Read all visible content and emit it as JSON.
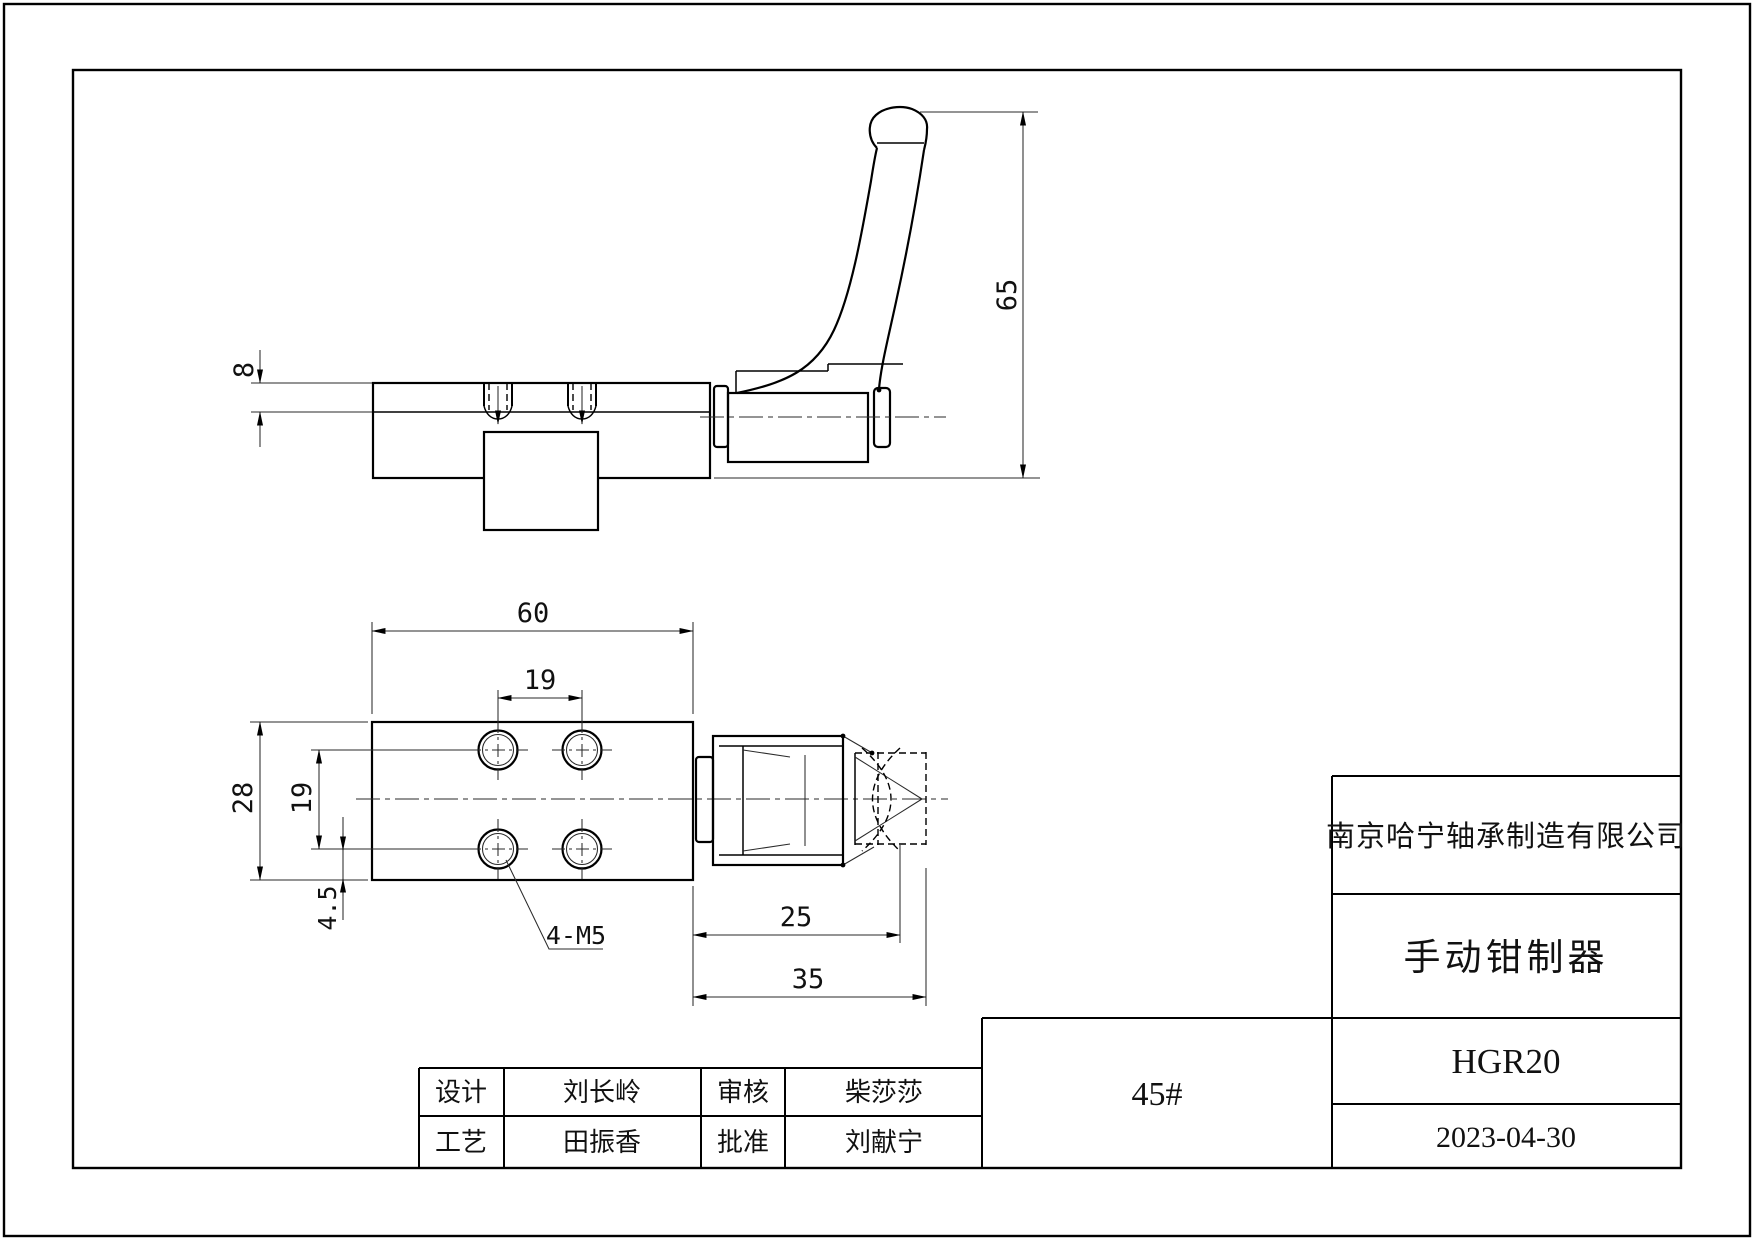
{
  "title_block": {
    "company": "南京哈宁轴承制造有限公司",
    "product_name": "手动钳制器",
    "model": "HGR20",
    "date": "2023-04-30",
    "material": "45#"
  },
  "approval_table": {
    "design_label": "设计",
    "design_name": "刘长岭",
    "review_label": "审核",
    "review_name": "柴莎莎",
    "process_label": "工艺",
    "process_name": "田振香",
    "approve_label": "批准",
    "approve_name": "刘献宁"
  },
  "dimensions": {
    "rail_height": "8",
    "total_height": "65",
    "block_width": "60",
    "hole_spacing_x": "19",
    "block_depth": "28",
    "hole_spacing_y": "19",
    "edge_offset": "4.5",
    "thread_callout": "4-M5",
    "body_length": "25",
    "total_length": "35"
  }
}
